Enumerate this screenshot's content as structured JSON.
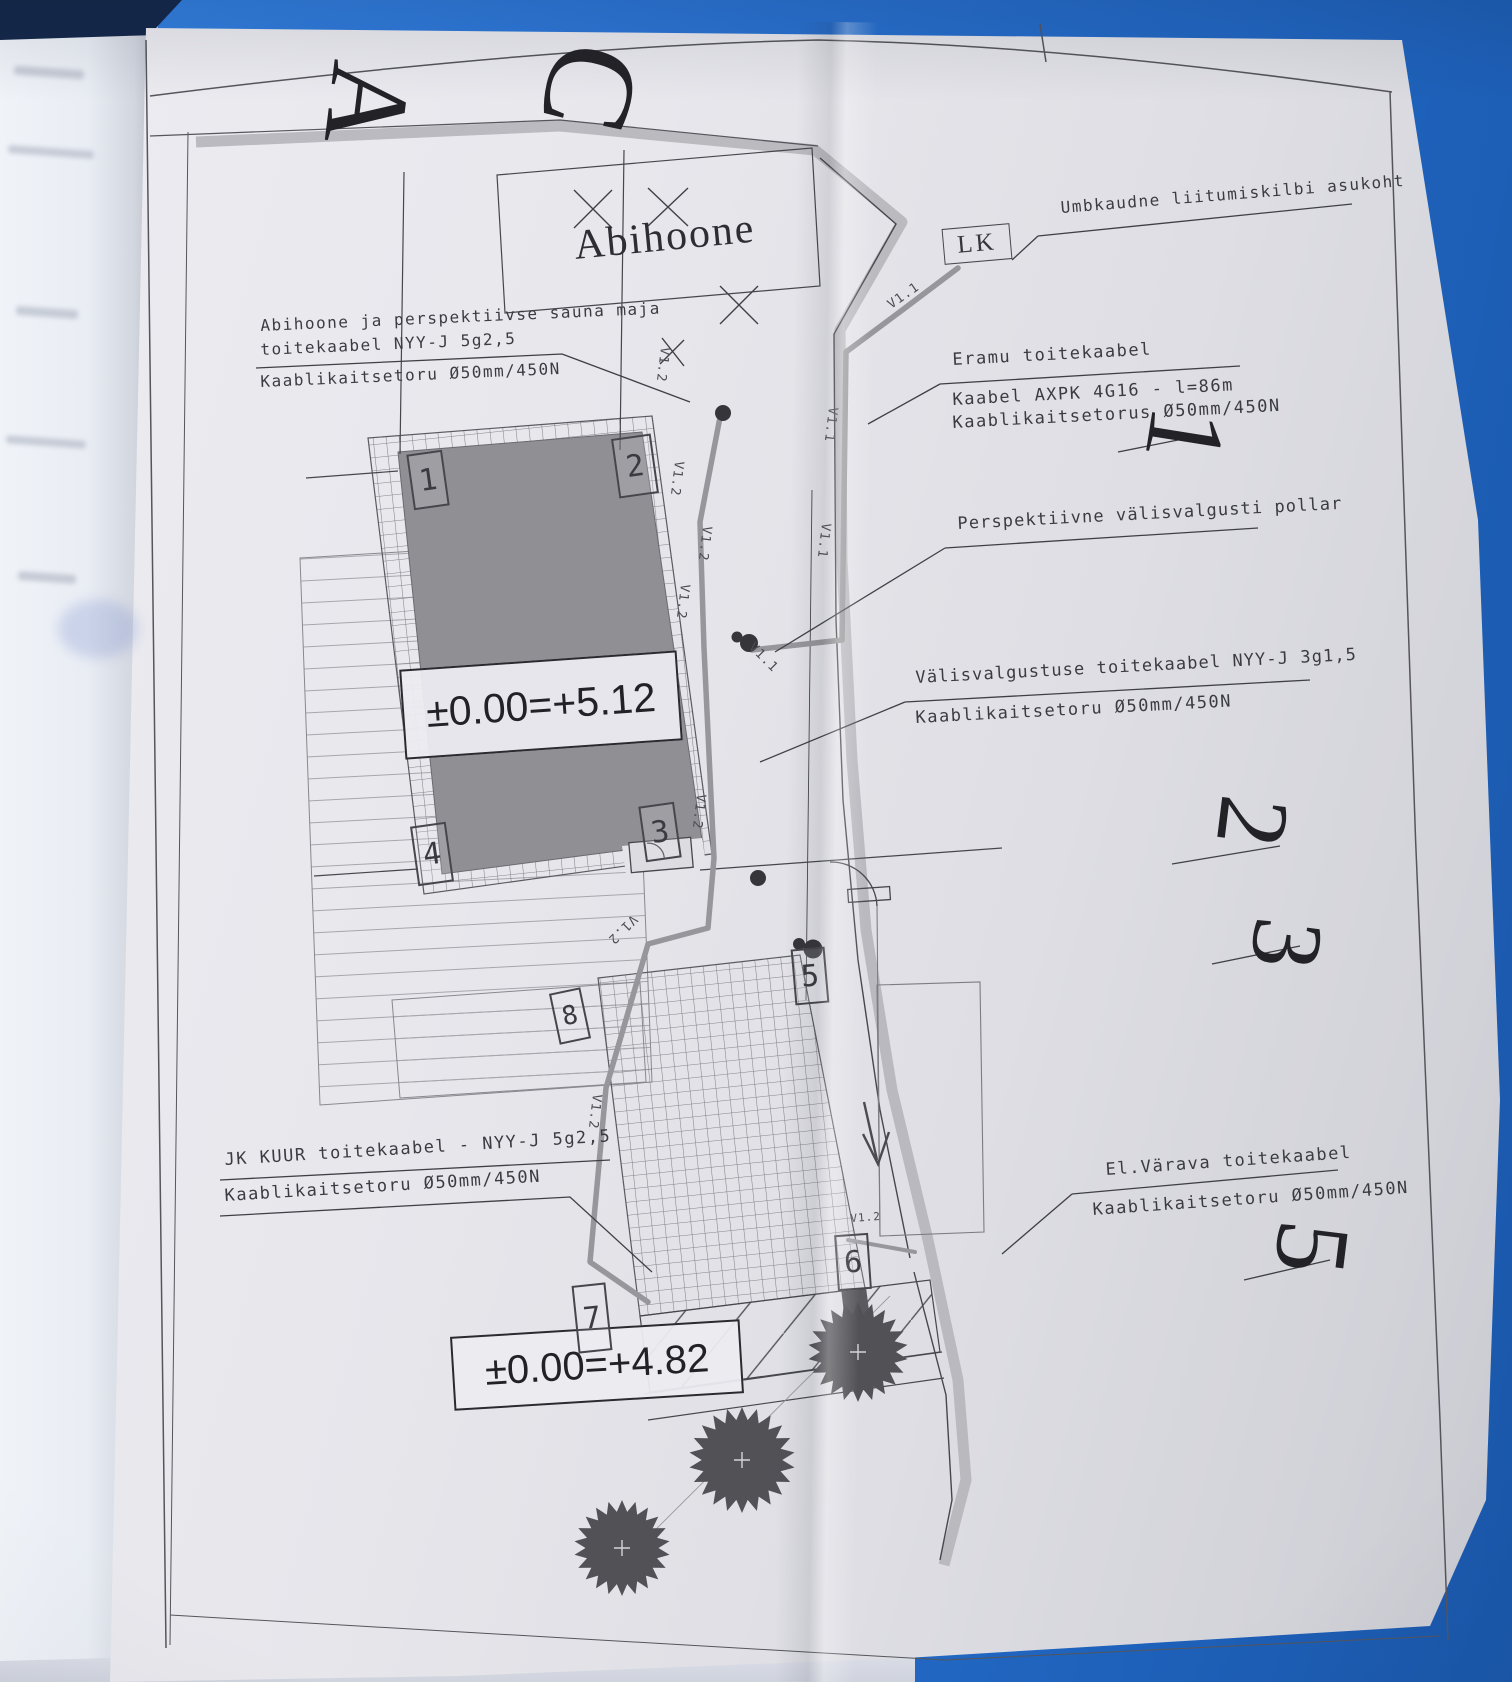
{
  "plan": {
    "grid_letters": [
      "A",
      "C"
    ],
    "grid_numbers": [
      "1",
      "2",
      "3",
      "5"
    ],
    "building": {
      "title": "Abihoone",
      "elevation_main": "±0.00=+5.12",
      "elevation_lower": "±0.00=+4.82"
    },
    "connection_box": {
      "label": "LK",
      "note": "Umbkaudne liitumiskilbi asukoht"
    },
    "callouts": {
      "eramu": {
        "title": "Eramu toitekaabel",
        "line1": "Kaabel AXPK 4G16 - l=86m",
        "line2": "Kaablikaitsetorus Ø50mm/450N"
      },
      "pollar": {
        "title": "Perspektiivne välisvalgusti pollar"
      },
      "valisvalgustus": {
        "line1": "Välisvalgustuse toitekaabel NYY-J 3g1,5",
        "line2": "Kaablikaitsetoru Ø50mm/450N"
      },
      "abihoone_sauna": {
        "line1": "Abihoone ja perspektiivse sauna maja",
        "line2": "toitekaabel NYY-J 5g2,5",
        "line3": "Kaablikaitsetoru Ø50mm/450N"
      },
      "jk_kuur": {
        "line1": "JK KUUR toitekaabel - NYY-J 5g2,5",
        "line2": "Kaablikaitsetoru Ø50mm/450N"
      },
      "varav": {
        "line1": "El.Värava toitekaabel",
        "line2": "Kaablikaitsetoru Ø50mm/450N"
      }
    },
    "corner_markers": [
      "1",
      "2",
      "3",
      "4",
      "5",
      "6",
      "7",
      "8"
    ],
    "cable_tags": {
      "v12": "V1.2",
      "v11": "V1.1"
    },
    "colors": {
      "cover_blue": "#2b74d4",
      "paper": "#e7e7ec",
      "building_fill": "#909094",
      "line_dark": "#3f3f45",
      "cable_gray": "#97979b"
    }
  }
}
